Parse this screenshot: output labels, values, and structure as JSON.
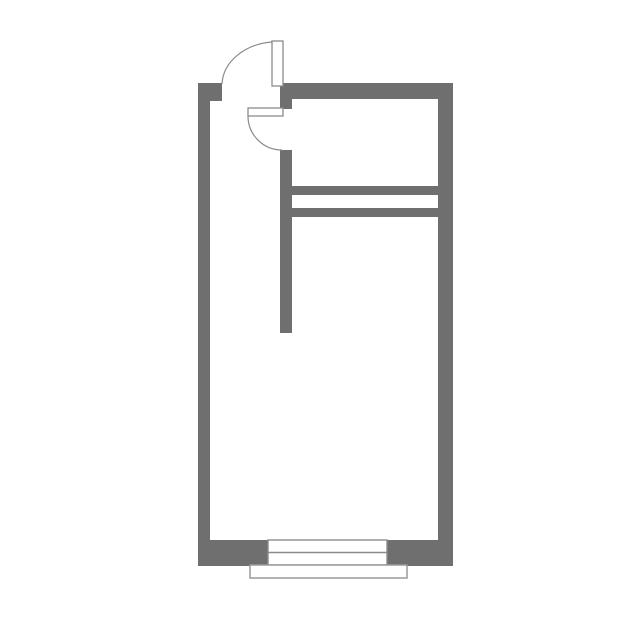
{
  "canvas": {
    "width": 644,
    "height": 635,
    "background": "#ffffff"
  },
  "colors": {
    "wall": "#6f6f6f",
    "outline": "#8b8b8b",
    "thin_outline": "#9a9a9a",
    "fill": "#ffffff"
  },
  "floorplan": {
    "walls": [
      {
        "name": "left-wall",
        "x": 198,
        "y": 83,
        "w": 12,
        "h": 483
      },
      {
        "name": "entry-door-jamb",
        "x": 210,
        "y": 83,
        "w": 12,
        "h": 18
      },
      {
        "name": "top-wall",
        "x": 280,
        "y": 83,
        "w": 173,
        "h": 16
      },
      {
        "name": "right-wall",
        "x": 438,
        "y": 83,
        "w": 15,
        "h": 483
      },
      {
        "name": "bottom-wall-left",
        "x": 198,
        "y": 540,
        "w": 70,
        "h": 26
      },
      {
        "name": "bottom-wall-right",
        "x": 387,
        "y": 540,
        "w": 66,
        "h": 26
      },
      {
        "name": "partition-wall-stub",
        "x": 280,
        "y": 99,
        "w": 12,
        "h": 10
      },
      {
        "name": "partition-wall",
        "x": 280,
        "y": 150,
        "w": 12,
        "h": 183
      },
      {
        "name": "closet-wall-upper",
        "x": 292,
        "y": 186,
        "w": 146,
        "h": 9
      },
      {
        "name": "closet-wall-lower",
        "x": 292,
        "y": 208,
        "w": 146,
        "h": 9
      }
    ],
    "doors": [
      {
        "name": "entry-door",
        "leaf": {
          "x": 272,
          "y": 41,
          "w": 11,
          "h": 45
        },
        "arc": "M 222 84 A 55 44 0 0 1 272 42"
      },
      {
        "name": "interior-door",
        "leaf": {
          "x": 248,
          "y": 108,
          "w": 35,
          "h": 8
        },
        "arc": "M 248 116 A 34 34 0 0 0 282 150"
      }
    ],
    "window": {
      "name": "window",
      "x": 268,
      "y": 540,
      "w": 119,
      "h": 25,
      "mid_y": 552.5
    },
    "sill": {
      "name": "window-sill",
      "x": 250,
      "y": 565,
      "w": 157,
      "h": 13
    }
  }
}
